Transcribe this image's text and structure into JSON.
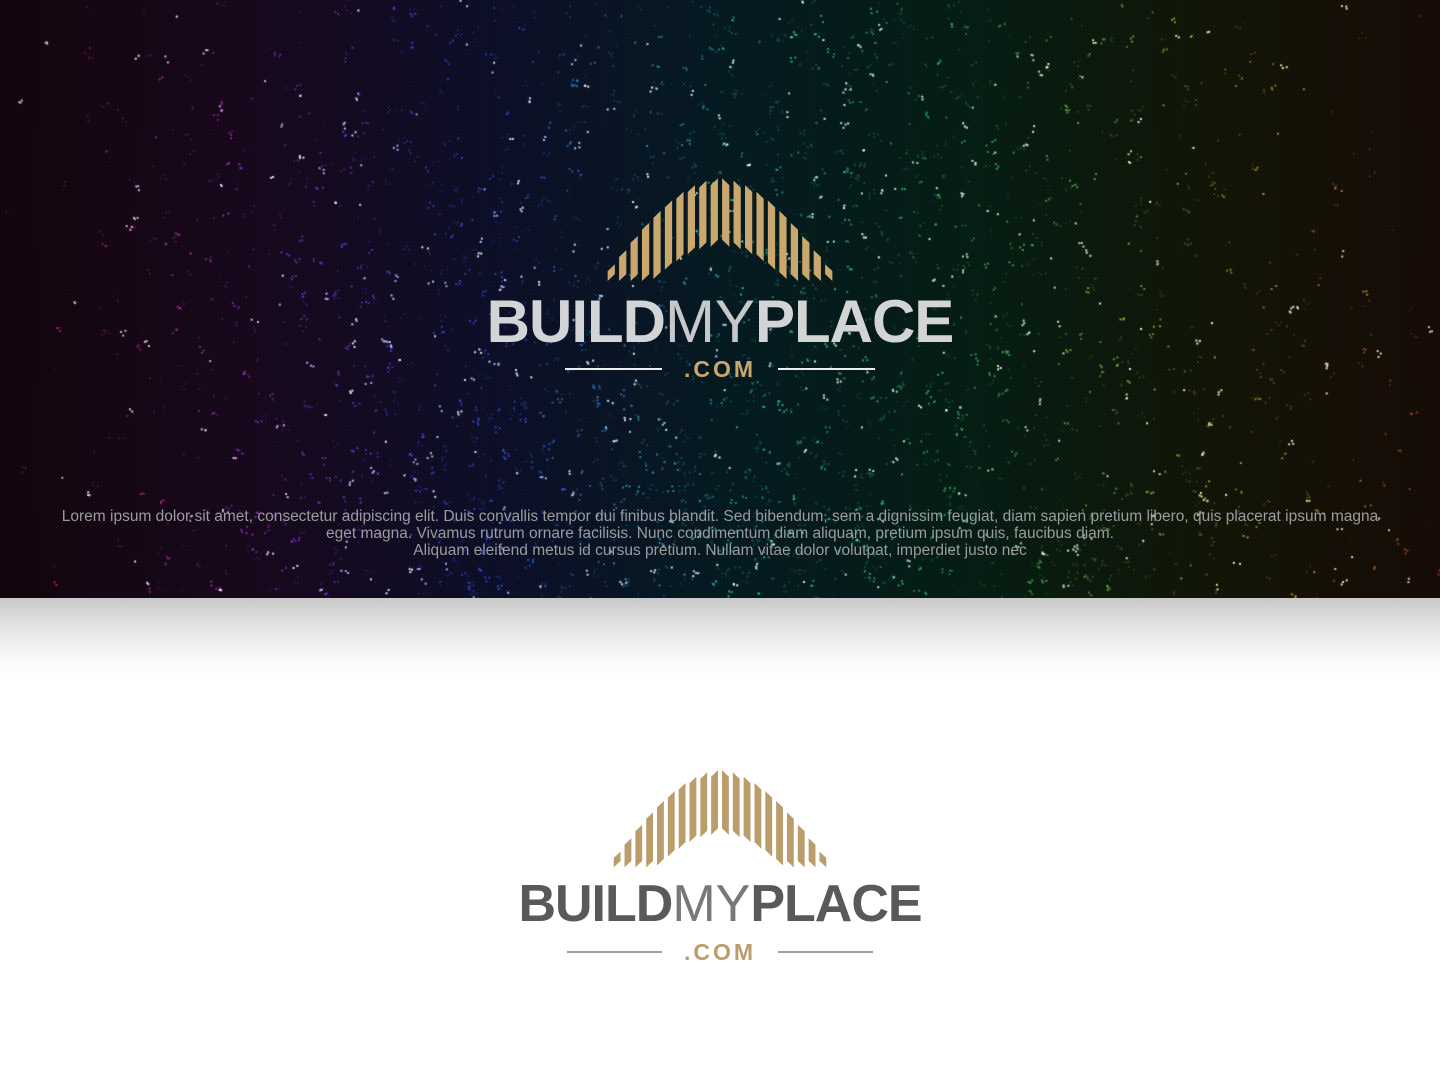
{
  "banner": {
    "background": "#030304",
    "palette": [
      "#d5295f",
      "#d92a8f",
      "#c32fd0",
      "#8d3af0",
      "#5346f5",
      "#2f5bff",
      "#30a8e8",
      "#2fd4cb",
      "#34d4a0",
      "#38cc6a",
      "#4cc84a",
      "#8fd343",
      "#ddd23a",
      "#e89a33",
      "#df472c"
    ],
    "lorem_lines": [
      "Lorem ipsum dolor sit amet, consectetur adipiscing elit. Duis convallis tempor dui finibus blandit. Sed bibendum, sem a dignissim feugiat, diam sapien pretium libero, quis placerat ipsum magna",
      "eget magna. Vivamus rutrum ornare facilisis. Nunc condimentum diam aliquam, pretium ipsum quis, faucibus diam.",
      "Aliquam eleifend metus id cursus pretium. Nullam vitae dolor volutpat, imperdiet justo nec"
    ]
  },
  "logo": {
    "build": "BUILD",
    "my": "MY",
    "place": "PLACE",
    "tld": ".COM"
  },
  "colors": {
    "gold_on_dark": "#c9a76d",
    "gold_on_light": "#bb9d6b",
    "wordmark_on_dark": "#d2d4d5",
    "wordmark_my_on_dark": "#c6c8ca",
    "wordmark_on_light": "#58595b",
    "wordmark_my_on_light": "#77787b",
    "rule_on_dark": "#ededed",
    "rule_on_light": "#9e9e9e",
    "lorem_text": "#9a9c9e"
  }
}
